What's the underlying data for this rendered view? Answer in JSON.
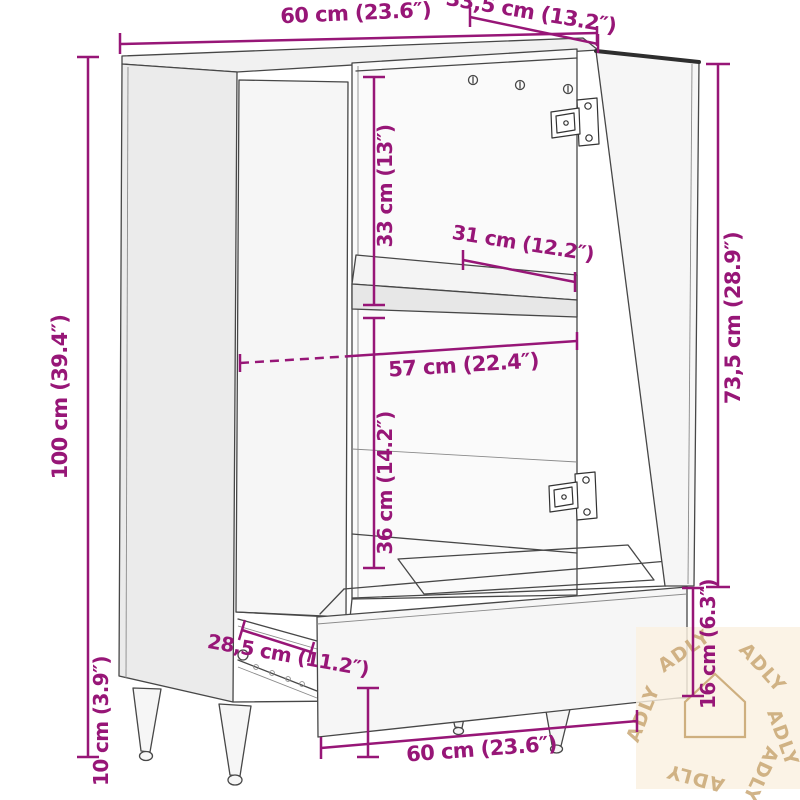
{
  "dimensions": {
    "top_width": "60 cm (23.6″)",
    "top_depth": "33,5 cm (13.2″)",
    "total_height": "100 cm (39.4″)",
    "upper_compartment_height": "33 cm (13″)",
    "shelf_depth": "31 cm (12.2″)",
    "interior_width": "57 cm (22.4″)",
    "lower_compartment_height": "36 cm (14.2″)",
    "door_height": "73,5 cm (28.9″)",
    "drawer_depth": "28,5 cm (11.2″)",
    "drawer_front_height": "16 cm (6.3″)",
    "leg_height": "10 cm (3.9″)",
    "bottom_width": "60 cm (23.6″)"
  },
  "watermark": {
    "brand": "ADLY",
    "logo": "house-outline-icon"
  },
  "colors": {
    "dimension": "#971677",
    "line_art": "#474747",
    "watermark": "#C6A26C",
    "watermark_bg": "#FAF0E1",
    "background": "#FFFFFF"
  }
}
